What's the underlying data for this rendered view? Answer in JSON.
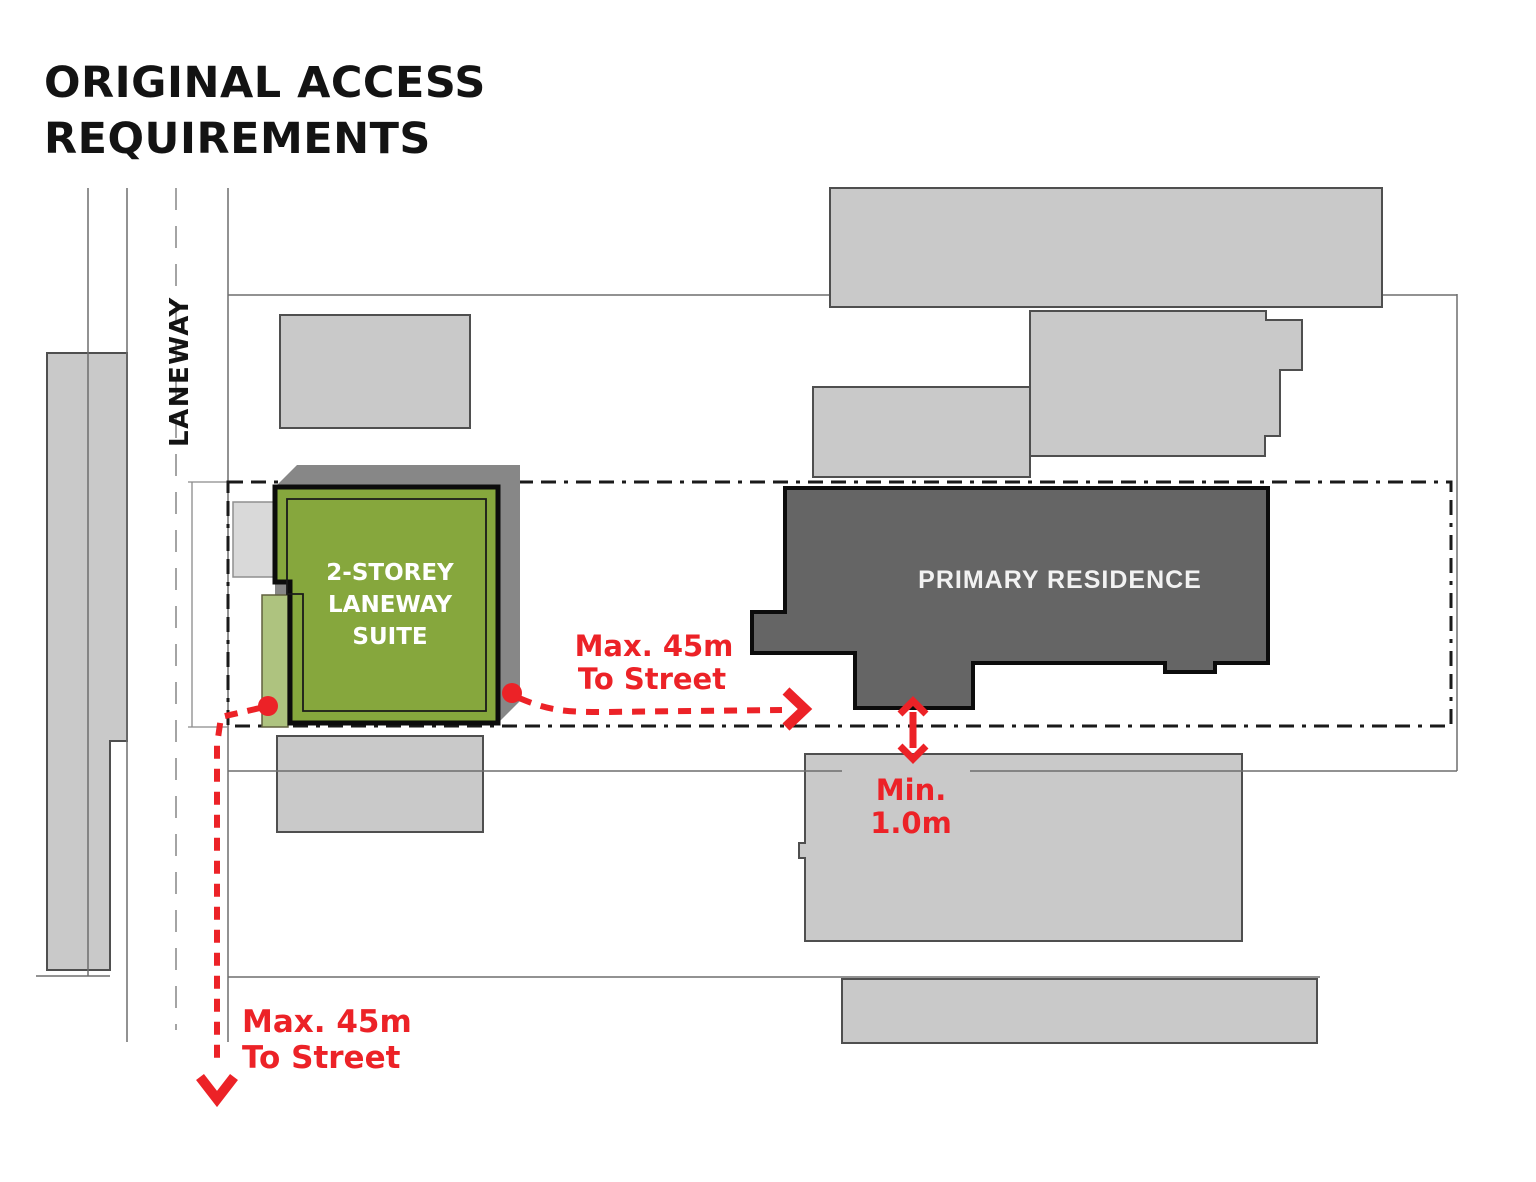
{
  "title": {
    "line1": "ORIGINAL ACCESS",
    "line2": "REQUIREMENTS"
  },
  "labels": {
    "laneway": "LANEWAY",
    "suite": [
      "2-STOREY",
      "LANEWAY",
      "SUITE"
    ],
    "residence": "PRIMARY RESIDENCE",
    "max45_mid": [
      "Max. 45m",
      "To Street"
    ],
    "max45_bottom": [
      "Max. 45m",
      "To Street"
    ],
    "min_setback": [
      "Min.",
      "1.0m"
    ]
  },
  "colors": {
    "suite_green": "#86A73D",
    "suite_light_green": "#AEC37F",
    "shadow_gray": "#878787",
    "residence_gray": "#656565",
    "building_gray": "#C9C9C9",
    "small_block_gray": "#D9D9D9",
    "accent_red": "#EC2227",
    "line_black": "#1A1A1A"
  }
}
